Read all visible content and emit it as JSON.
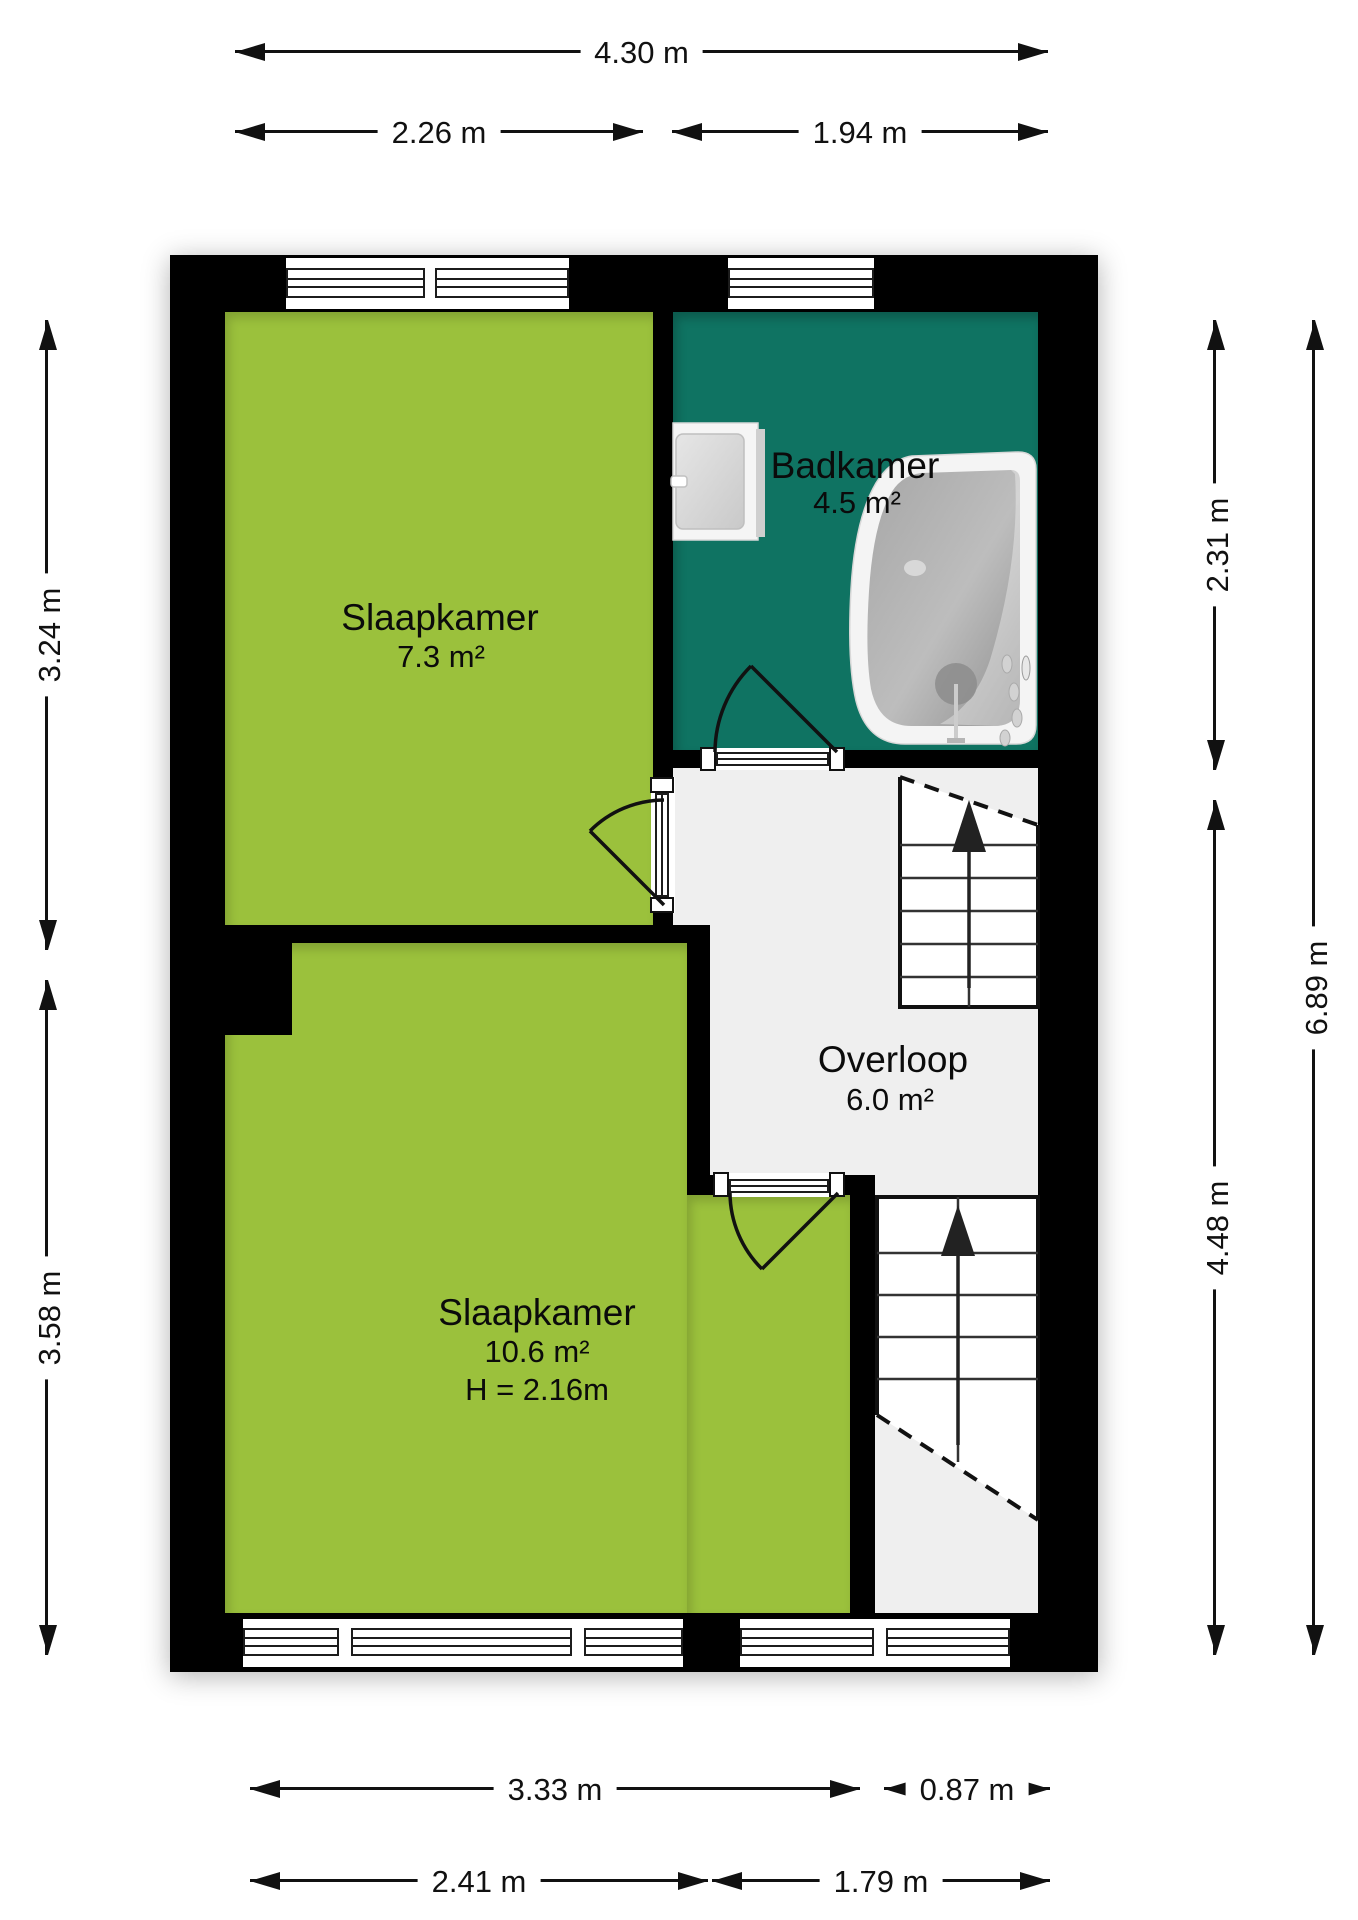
{
  "rooms": [
    {
      "key": "slaapkamer-1",
      "name": "Slaapkamer",
      "area": "7.3 m²"
    },
    {
      "key": "badkamer",
      "name": "Badkamer",
      "area": "4.5 m²"
    },
    {
      "key": "overloop",
      "name": "Overloop",
      "area": "6.0 m²"
    },
    {
      "key": "slaapkamer-2",
      "name": "Slaapkamer",
      "area": "10.6 m²",
      "ceiling_height": "H = 2.16m"
    }
  ],
  "dimensions": {
    "top": [
      {
        "label": "4.30 m"
      },
      {
        "label": "2.26 m"
      },
      {
        "label": "1.94 m"
      }
    ],
    "left": [
      {
        "label": "3.24 m"
      },
      {
        "label": "3.58 m"
      }
    ],
    "right": [
      {
        "label": "2.31 m"
      },
      {
        "label": "4.48 m"
      },
      {
        "label": "6.89 m"
      }
    ],
    "bottom": [
      {
        "label": "3.33 m"
      },
      {
        "label": "0.87 m"
      },
      {
        "label": "2.41 m"
      },
      {
        "label": "1.79 m"
      }
    ]
  },
  "colors": {
    "bedroom": "#9BC13C",
    "bathroom": "#0F7362",
    "hallway": "#EFEFEF",
    "wall": "#000000",
    "stairs": "#FFFFFF",
    "background": "#FFFFFF"
  }
}
